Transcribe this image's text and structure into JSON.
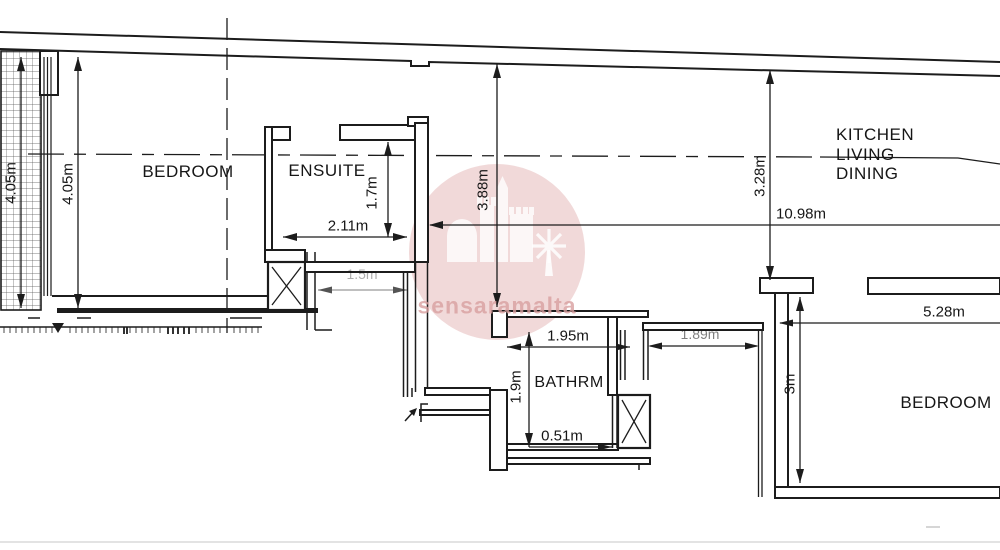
{
  "rooms": {
    "bedroom_left": "BEDROOM",
    "ensuite": "ENSUITE",
    "kitchen": {
      "line1": "KITCHEN",
      "line2": "LIVING",
      "line3": "DINING"
    },
    "bathroom": "BATHRM",
    "bedroom_right": "BEDROOM"
  },
  "dimensions": {
    "balcony_height_outer": "4.05m",
    "balcony_height_inner": "4.05m",
    "ensuite_depth": "1.7m",
    "ensuite_width": "2.11m",
    "hall_width": "1.5m",
    "living_depth_left": "3.88m",
    "living_depth_right": "3.28m",
    "living_width": "10.98m",
    "bathroom_width": "1.95m",
    "bathroom_depth": "1.9m",
    "bathroom_offset": "0.51m",
    "corridor_width": "1.89m",
    "bedroom_right_depth": "3m",
    "bedroom_right_width": "5.28m"
  },
  "watermark": {
    "text": "sensaramalta"
  },
  "icons": {
    "shaft_symbol": "x-cross-shaft",
    "windmill": "windmill-icon",
    "castle": "castle-skyline-icon"
  },
  "colors": {
    "line": "#1c1c1c",
    "watermark_pink": "#cc7777",
    "dim_text": "#161616"
  }
}
